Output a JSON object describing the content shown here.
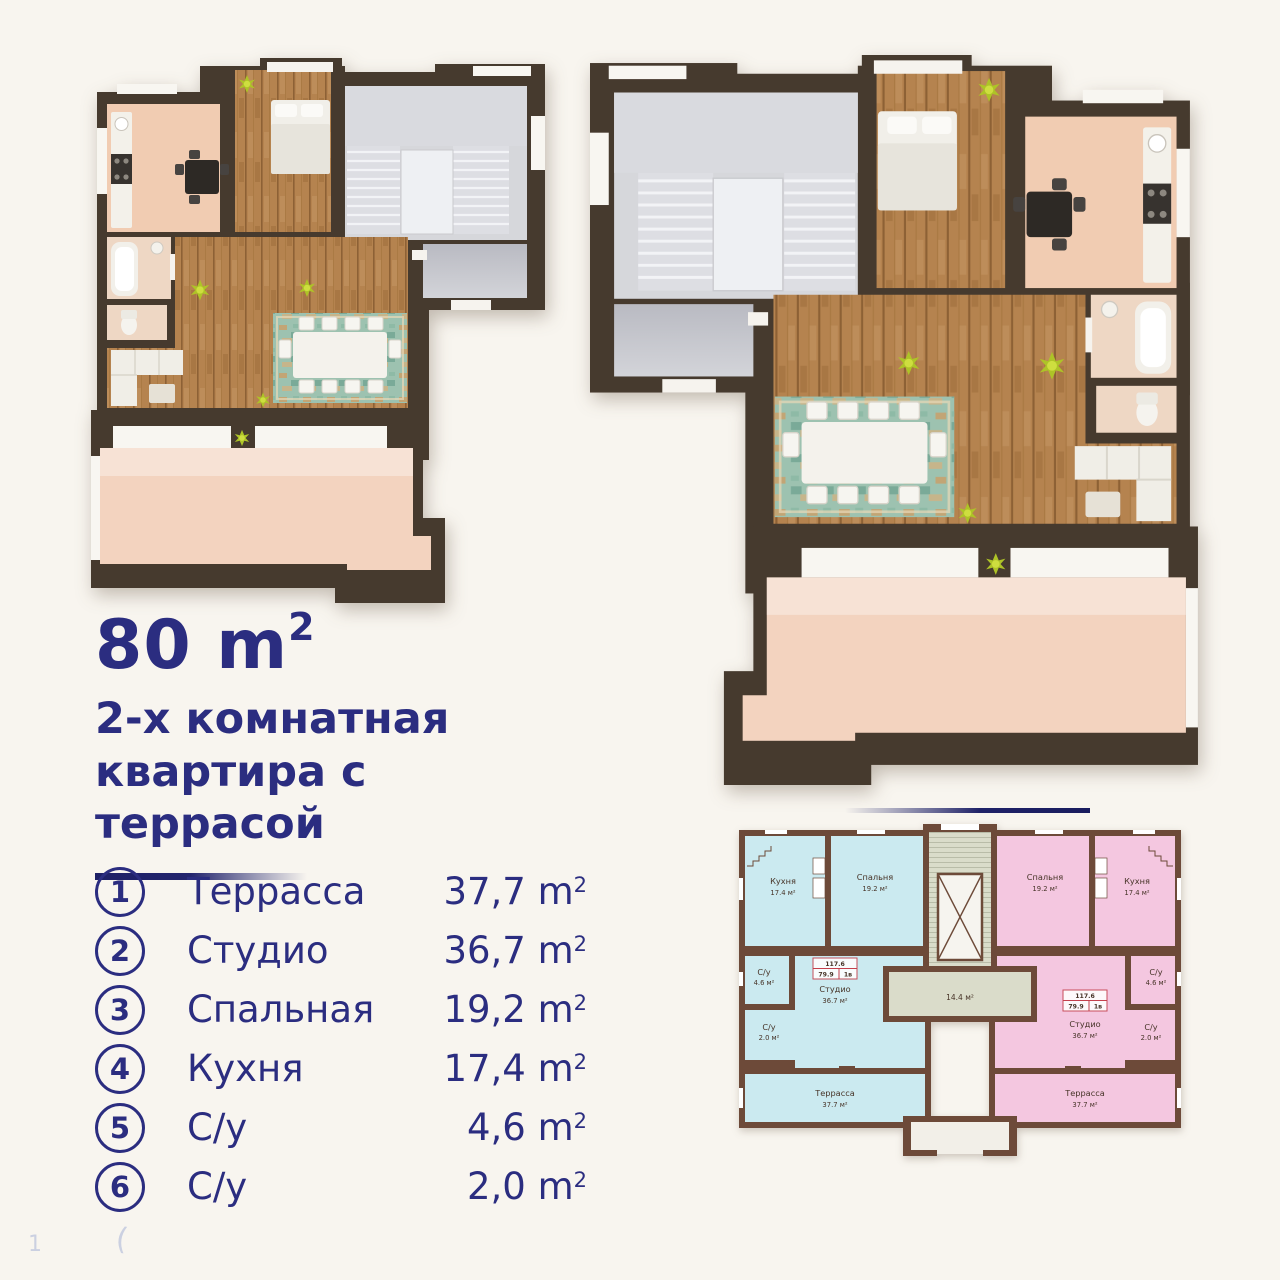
{
  "page": {
    "background": "#f8f5ef",
    "accent_navy": "#2b2d80"
  },
  "title": {
    "area_value": "80 m",
    "area_sup": "2",
    "line1": "2-х комнатная",
    "line2": "квартира с террасой"
  },
  "legend": {
    "items": [
      {
        "num": "1",
        "label": "Террасса",
        "value": "37,7 m",
        "sup": "2"
      },
      {
        "num": "2",
        "label": "Студио",
        "value": "36,7 m",
        "sup": "2"
      },
      {
        "num": "3",
        "label": "Спальная",
        "value": "19,2 m",
        "sup": "2"
      },
      {
        "num": "4",
        "label": "Кухня",
        "value": "17,4 m",
        "sup": "2"
      },
      {
        "num": "5",
        "label": "С/у",
        "value": "4,6 m",
        "sup": "2"
      },
      {
        "num": "6",
        "label": "С/у",
        "value": "2,0 m",
        "sup": "2"
      }
    ]
  },
  "miniplan": {
    "hall_area": "14.4 м²",
    "badge": {
      "total": "117.6",
      "living": "79.9",
      "type": "1в"
    },
    "rooms": {
      "kitchen": {
        "name": "Кухня",
        "area": "17.4 м²"
      },
      "bedroom": {
        "name": "Спальня",
        "area": "19.2 м²"
      },
      "su1": {
        "name": "С/у",
        "area": "4.6 м²"
      },
      "su2": {
        "name": "С/у",
        "area": "2.0 м²"
      },
      "studio": {
        "name": "Студио",
        "area": "36.7 м²"
      },
      "terrace": {
        "name": "Террасса",
        "area": "37.7 м²"
      }
    },
    "colors": {
      "left_unit": "#cbeaf0",
      "right_unit": "#f4c7e0",
      "walls": "#6d4a39",
      "core": "#dadcca",
      "badge_red": "#c4404d"
    }
  },
  "plans3d": {
    "walls": "#463a2e",
    "wood_floor": "#b5834f",
    "kitchen_floor": "#f1ccb2",
    "terrace_floor": "#f3d3bf",
    "stairs_floor": "#d6d7db",
    "rug": "#9dc2b0"
  },
  "artifacts": {
    "page_number": "1",
    "stray_mark": "("
  }
}
